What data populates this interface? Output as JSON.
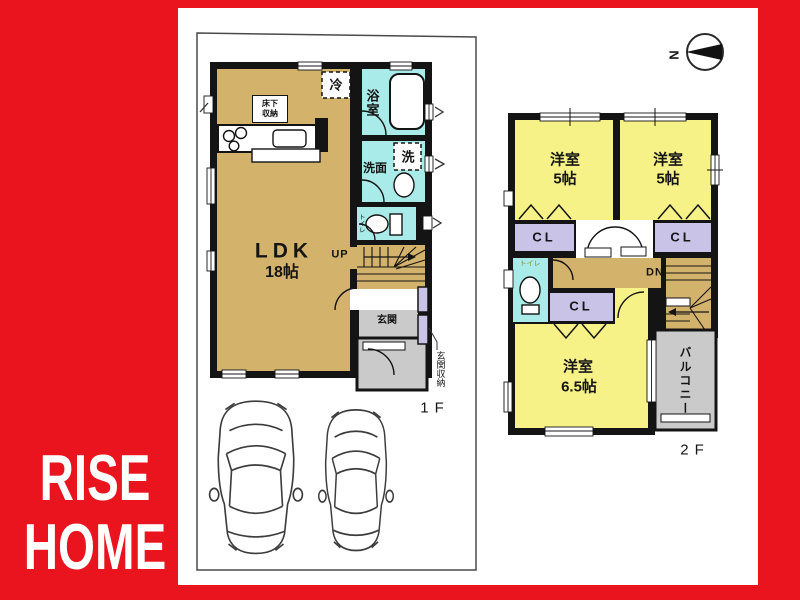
{
  "brand": {
    "line1": "RISE",
    "line2": "HOME"
  },
  "compass": {
    "north_letter": "N"
  },
  "floor1": {
    "floor_label": "1F",
    "ldk_name": "LDK",
    "ldk_size": "18帖",
    "stairs_label": "UP",
    "fridge": "冷",
    "underfloor_storage_line1": "床下",
    "underfloor_storage_line2": "収納",
    "bath": "浴室",
    "washer": "洗",
    "washroom": "洗面",
    "toilet": "トイレ",
    "entrance": "玄関",
    "entrance_storage": "玄関収納"
  },
  "floor2": {
    "floor_label": "2F",
    "bedroom1_name": "洋室",
    "bedroom1_size": "5帖",
    "bedroom2_name": "洋室",
    "bedroom2_size": "5帖",
    "bedroom3_name": "洋室",
    "bedroom3_size": "6.5帖",
    "closet1": "CL",
    "closet2": "CL",
    "closet3": "CL",
    "toilet": "トイレ",
    "stairs_label": "DN",
    "balcony": "バルコニー"
  },
  "colors": {
    "brand_red": "#e9141d",
    "room_tan": "#d3b26c",
    "room_yellow": "#f6f288",
    "wet_cyan": "#a9ebe8",
    "closet_purple": "#c9c3e8",
    "area_gray": "#cacaca",
    "wall_black": "#141414"
  }
}
